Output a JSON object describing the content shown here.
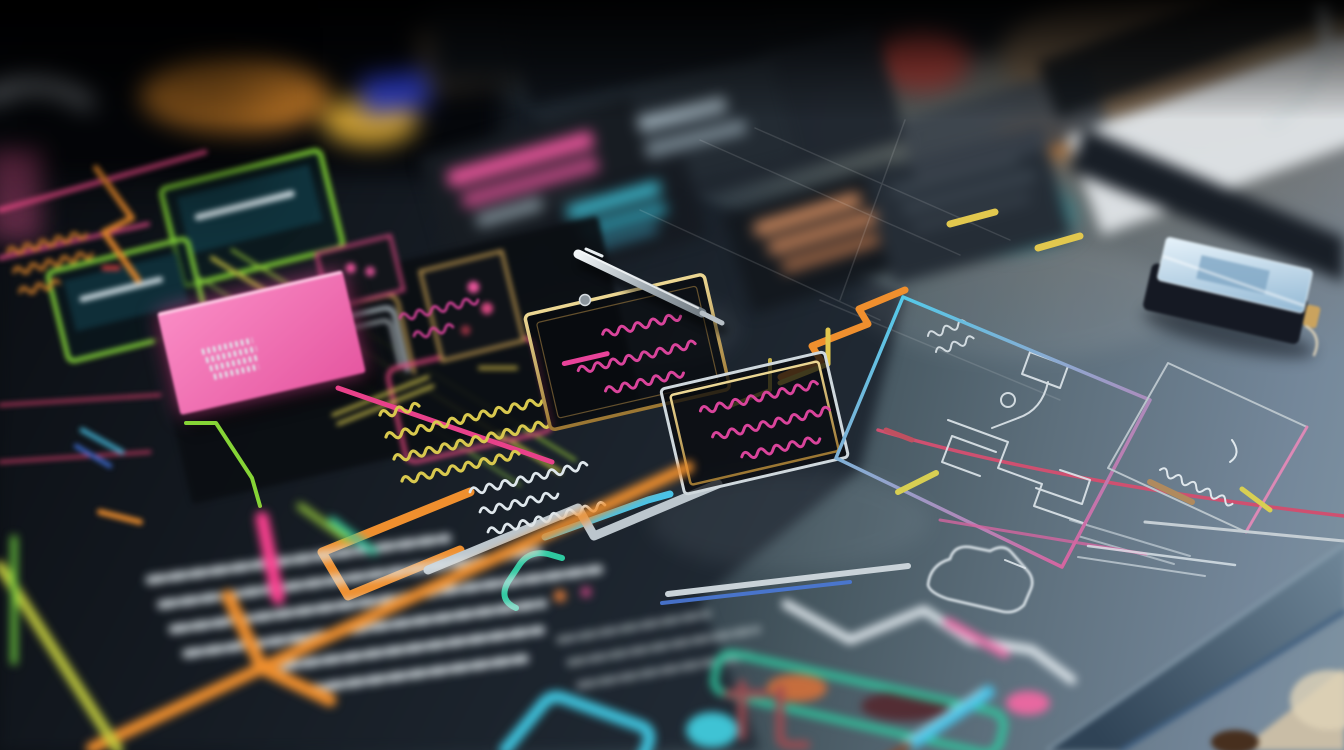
{
  "image": {
    "kind": "macro photograph, shallow depth of field",
    "subject": "Hand-drawn neon flowchart / circuit-style mind map sketched on a dark desk mat, with a pink sticky note, a metal stylus pen, a small handheld device and marker pens scattered around",
    "focus_region": "center of the board: gold-outlined boxes with magenta scribbles and colorful traces",
    "blur_regions": "top background, left cluster, bottom foreground and right desk edge are bokeh-blurred",
    "legible_text": "none - every written mark is an illegible scribble"
  },
  "palette": {
    "board_dark": "#0d1117",
    "board_slate": "#5d6f7c",
    "table_warm": "#75604a",
    "table_light": "#c9bda6",
    "note_pink": "#f06ab2",
    "neon_pink": "#ff4191",
    "neon_magenta": "#d9449b",
    "neon_crimson": "#c23a62",
    "neon_orange": "#ef8f2e",
    "neon_yellow": "#e2c84e",
    "marker_yellow": "#d8c84e",
    "neon_lime": "#9acc3a",
    "neon_green": "#7ecb34",
    "neon_teal": "#2ec9a0",
    "neon_cyan": "#49c3e8",
    "neon_blue": "#4a79d8",
    "royal_blue": "#2e3fd4",
    "gold": "#c9a84c",
    "silver": "#bcc6cd",
    "chalk_white": "#dfe7ec",
    "salmon": "#cf8a5e",
    "maroon": "#a04a50",
    "device_screen": "#b8d4ea",
    "laptop_white": "#e2e7ea"
  },
  "objects": [
    {
      "name": "sticky-note",
      "description": "bright pink glowing sticky note, tilted",
      "color": "note_pink"
    },
    {
      "name": "stylus-pen",
      "description": "metal stylus pen lying diagonally on the board",
      "color": "silver"
    },
    {
      "name": "screw",
      "description": "small metal screw beside the pen",
      "color": "silver"
    },
    {
      "name": "gold-box-a",
      "description": "gold-outlined flowchart box with magenta scribble text and a pink underline",
      "color": "gold"
    },
    {
      "name": "gold-box-b",
      "description": "silver-and-gold outlined flowchart box with magenta scribble text",
      "color": "gold"
    },
    {
      "name": "green-panel-1",
      "description": "green neon outlined card with teal screen and white bar",
      "color": "neon_green"
    },
    {
      "name": "green-panel-2",
      "description": "second green neon outlined card",
      "color": "neon_green"
    },
    {
      "name": "yellow-scribble-block",
      "description": "rows of yellow handwritten scribbles",
      "color": "marker_yellow"
    },
    {
      "name": "white-scribble-block",
      "description": "rows of white chalk scribbles",
      "color": "chalk_white"
    },
    {
      "name": "chalk-schematic",
      "description": "white chalk circuit schematic on the slate half of the board",
      "color": "chalk_white"
    },
    {
      "name": "chalk-car-outline",
      "description": "chalk outline blob resembling a small car",
      "color": "chalk_white"
    },
    {
      "name": "cyan-panel",
      "description": "large tilted panel outlined cyan fading to pink",
      "color": "neon_cyan"
    },
    {
      "name": "side-panel",
      "description": "thin silver panel with pink edge and chalk marks inside",
      "color": "silver"
    },
    {
      "name": "handheld-device",
      "description": "small dark handheld device with glossy blue screen and tiny cable",
      "color": "device_screen"
    },
    {
      "name": "trace-network",
      "description": "orange, yellow, green, teal, cyan, blue, magenta and silver circuit-style traces weaving across the board",
      "color": "neon_orange"
    },
    {
      "name": "foreground-marker-lines",
      "description": "out-of-focus thick pink, orange, lime and cyan marker lines in the foreground",
      "color": "neon_pink"
    },
    {
      "name": "teal-gadget",
      "description": "blurred teal-outlined elongated gadget with orange, maroon and pink inserts",
      "color": "neon_teal"
    },
    {
      "name": "cyan-pen",
      "description": "blurred cyan pen entering from the bottom edge",
      "color": "neon_cyan"
    },
    {
      "name": "chalk-paragraphs",
      "description": "blurred blocks of white chalk handwriting, bottom left",
      "color": "chalk_white"
    },
    {
      "name": "bar-cards",
      "description": "blurred dark cards with pink, cyan, gray and salmon bars in the upper background",
      "color": "salmon"
    },
    {
      "name": "laptop-edge",
      "description": "blurred white laptop or paper edge, top right",
      "color": "laptop_white"
    },
    {
      "name": "desk-edge",
      "description": "desk mat edge with blue rim and warm table corner, bottom right",
      "color": "table_light"
    }
  ]
}
